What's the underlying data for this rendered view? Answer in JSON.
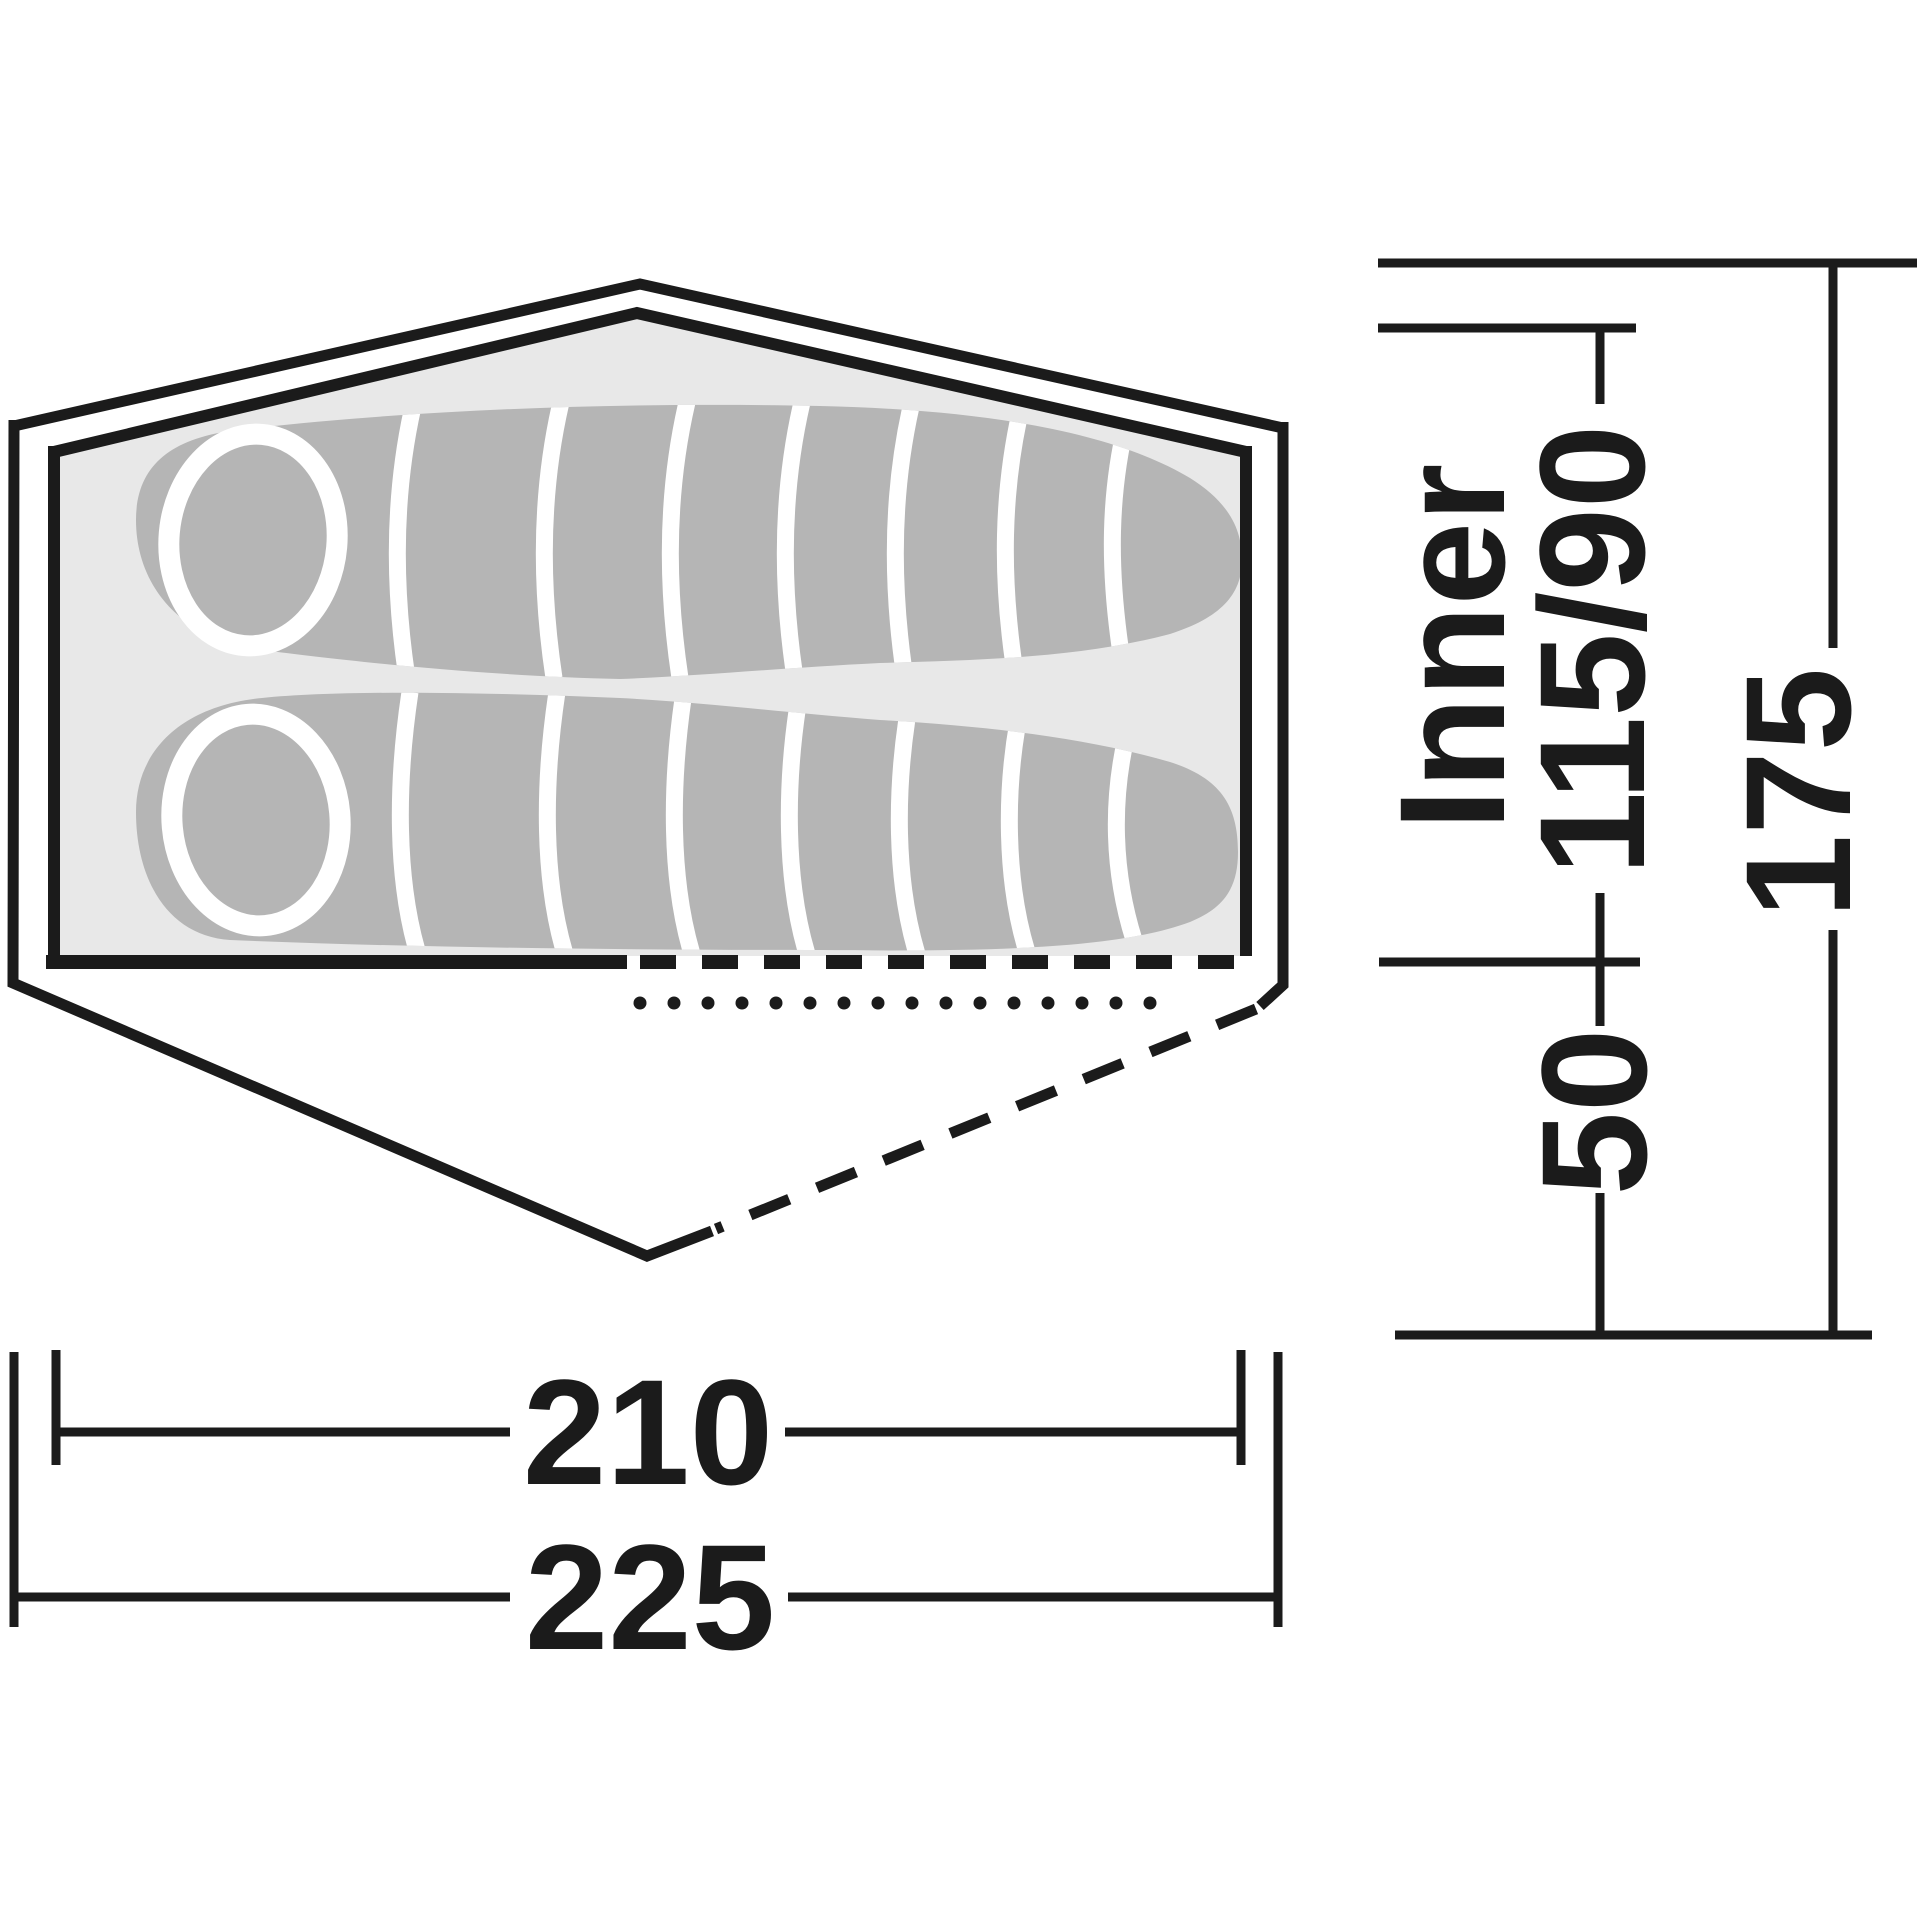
{
  "page": {
    "title": "Tent floor plan dimension diagram",
    "view": "top-down"
  },
  "diagram": {
    "kind": "tent-top-view",
    "features": [
      "flysheet-outline",
      "inner-tent-floor",
      "two-sleeping-bags",
      "porch-dashed-outline",
      "door-dashed-line",
      "ventilation-dotted-line"
    ]
  },
  "dimensions": {
    "inner_label": "Inner",
    "inner_width": "115/90",
    "porch_depth": "50",
    "total_width": "175",
    "inner_length": "210",
    "total_length": "225"
  },
  "colors": {
    "line": "#1b1b1b",
    "floor": "#e8e8e8",
    "sleeping_bag": "#b5b5b5",
    "detail_white": "#ffffff",
    "background": "#ffffff"
  }
}
